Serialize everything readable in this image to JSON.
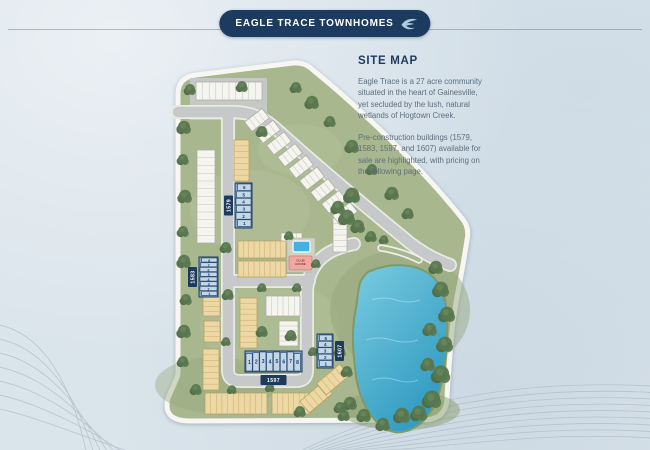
{
  "banner": {
    "title": "EAGLE TRACE TOWNHOMES",
    "logo_icon": "eagle-icon"
  },
  "info": {
    "heading": "SITE MAP",
    "paragraphs": [
      "Eagle Trace is a 27 acre community situated in the heart of Gainesville, yet secluded by the lush, natural wetlands of Hogtown Creek.",
      "Pre-construction buildings (1579, 1583, 1597, and 1607) available for sale are highlighted, with pricing on the following page."
    ]
  },
  "map": {
    "highlighted_buildings": [
      {
        "label": "1579",
        "units": [
          "6",
          "5",
          "4",
          "3",
          "2",
          "1"
        ]
      },
      {
        "label": "1583",
        "units": [
          "8",
          "7",
          "6",
          "5",
          "4",
          "3",
          "2",
          "1"
        ]
      },
      {
        "label": "1597",
        "units": [
          "1",
          "2",
          "3",
          "4",
          "5",
          "6",
          "7",
          "8"
        ]
      },
      {
        "label": "1607",
        "units": [
          "5",
          "4",
          "3",
          "2",
          "1"
        ]
      }
    ],
    "amenities": {
      "clubhouse_label": "CLUB HOUSE"
    },
    "colors": {
      "accent_navy": "#1d3b5e",
      "highlight_building_blue": "#7ea7cc",
      "unit_cell_blue": "#c3d7e8",
      "tan_building": "#ecd8a4",
      "white_building": "#f5f4ef",
      "site_green": "#a9b78e",
      "road_gray": "#c6c8c9",
      "pond_blue": "#3fa8cd",
      "clubhouse_pink": "#f0a8a2",
      "pool_blue": "#45b1e2",
      "page_background": "#dae4eb"
    }
  }
}
